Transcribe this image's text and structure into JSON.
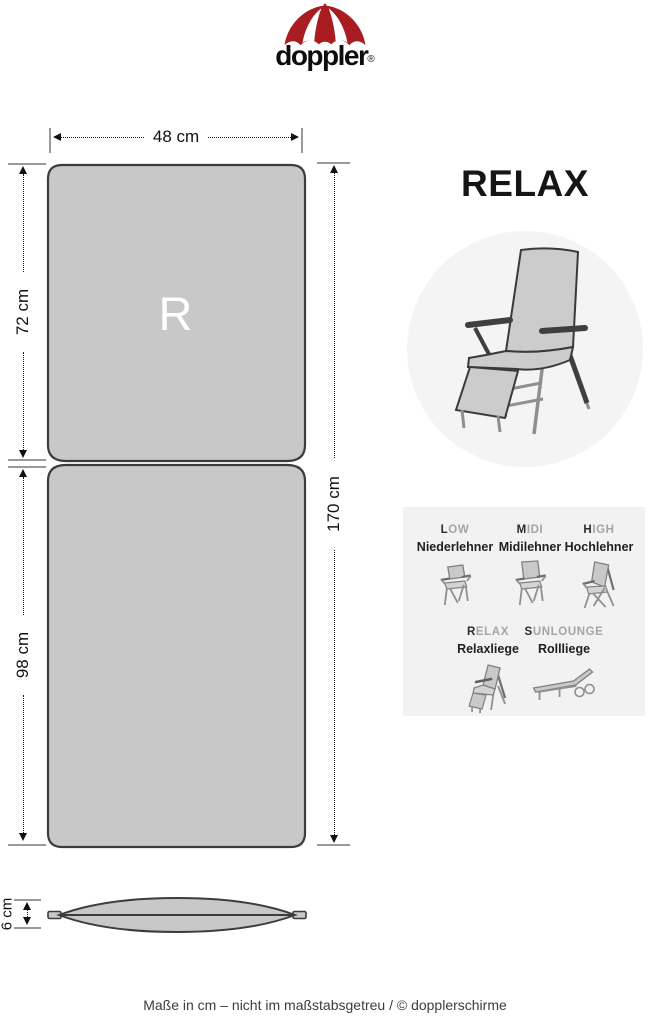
{
  "logo": {
    "brand": "doppler",
    "registered": "®"
  },
  "title": "RELAX",
  "cushion": {
    "marking": "R"
  },
  "dimensions": {
    "width": "48 cm",
    "back_length": "72 cm",
    "seat_length": "98 cm",
    "total_length": "170 cm",
    "thickness": "6 cm"
  },
  "types": {
    "items": [
      {
        "initial": "L",
        "rest": "OW",
        "name": "Niederlehner"
      },
      {
        "initial": "M",
        "rest": "IDI",
        "name": "Midilehner"
      },
      {
        "initial": "H",
        "rest": "IGH",
        "name": "Hochlehner"
      },
      {
        "initial": "R",
        "rest": "ELAX",
        "name": "Relaxliege"
      },
      {
        "initial": "S",
        "rest": "UNLOUNGE",
        "name": "Rollliege"
      }
    ]
  },
  "footer": {
    "note": "Maße in cm – nicht im maßstabsgetreu / © dopplerschirme"
  },
  "colors": {
    "brand_red": "#a81c22",
    "cushion_gray": "#c8c8c8",
    "outline_gray": "#3c3c3c",
    "panel_gray": "#f2f2f2",
    "circle_gray": "#f4f4f4"
  }
}
